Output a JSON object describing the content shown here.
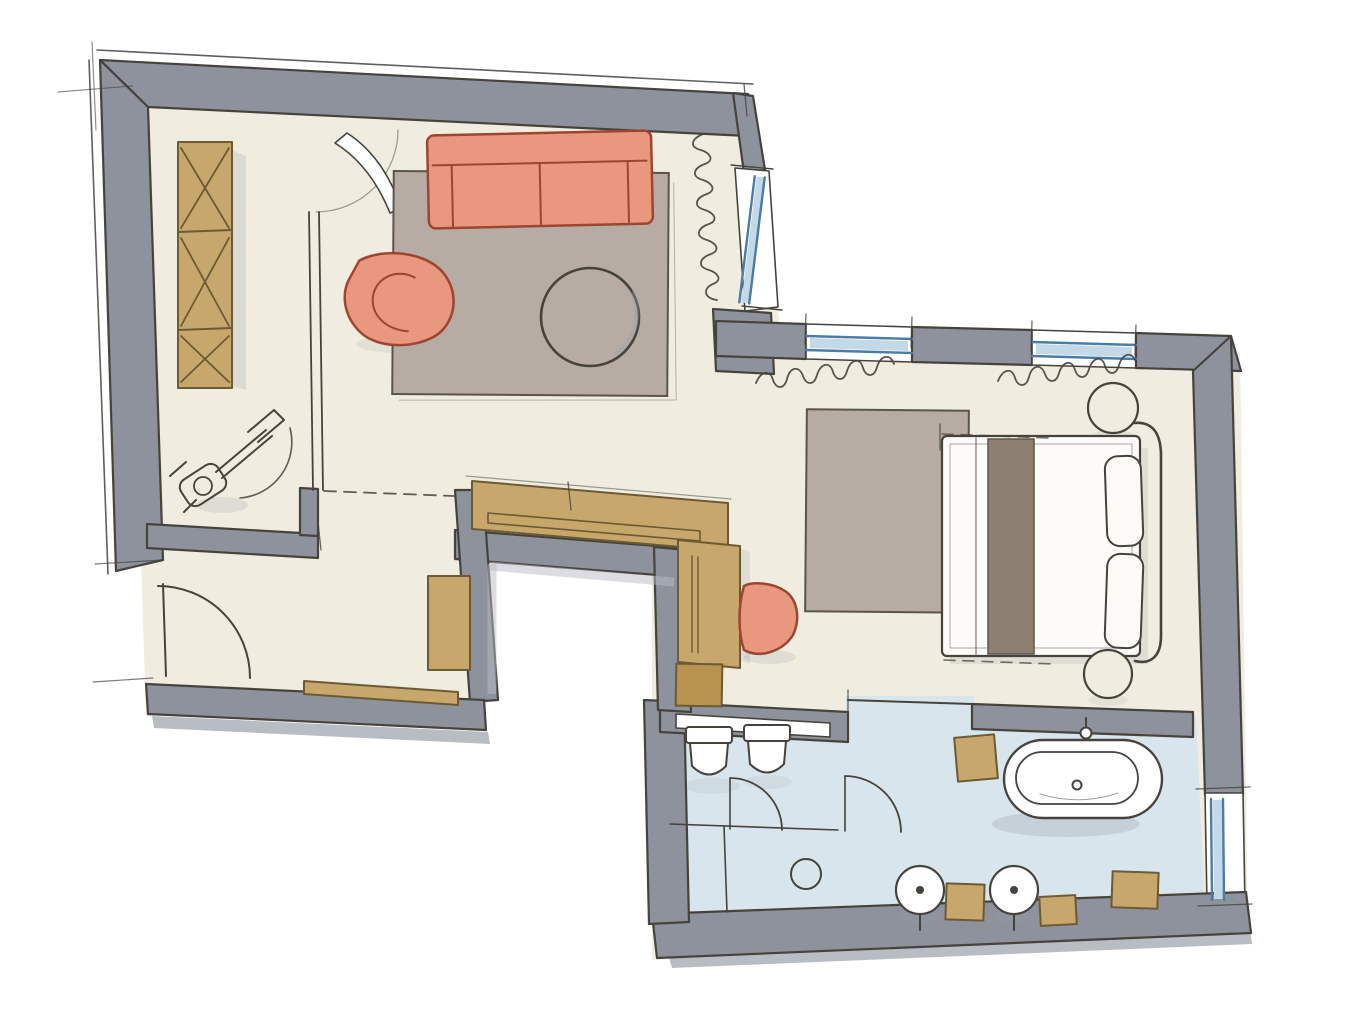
{
  "meta": {
    "kind": "hand-drawn-floor-plan-sketch",
    "canvas": {
      "width": 1366,
      "height": 1024
    }
  },
  "palette": {
    "background": "#ffffff",
    "paper_white": "#ffffff",
    "floor_cream": "#f0ecdf",
    "floor_bath_blue": "#d9e5ec",
    "wall_gray": "#8d929d",
    "wall_shadow": "#b8bcc3",
    "pencil": "#46433d",
    "wood_tan": "#c8a76d",
    "wood_dark": "#6b5a33",
    "wood_dark_sq": "#b8934f",
    "accent_salmon": "#ea977f",
    "salmon_outline": "#9c4630",
    "rug_taupe": "#b7aca4",
    "rug_line": "#5a544d",
    "runner_taupe": "#8d8073",
    "runner_line": "#5f564c",
    "glass_blue_fill": "#c3d9e8",
    "glass_blue_line": "#4a7ca6",
    "shade_gray": "#98a0a8",
    "bed_white": "#fcfbf7"
  },
  "inventory": {
    "rooms": [
      "entry-corridor",
      "living-room",
      "hall",
      "wardrobe-corridor",
      "bedroom",
      "wc",
      "bathroom",
      "light-well-notch"
    ],
    "openings": [
      "entry-door",
      "living-room-door",
      "slanted-living-window",
      "bedroom-window-left",
      "bedroom-window-right",
      "bathroom-window",
      "wc-sliding-slot",
      "wc-door-swing",
      "bathroom-door-swing",
      "open-passage"
    ],
    "furniture": [
      "x-braced-shelf",
      "valet-stand-sketch",
      "sofa",
      "armchair",
      "round-coffee-table",
      "living-rug",
      "hall-bench",
      "hall-cabinet",
      "built-in-counter",
      "tall-closet",
      "wood-cube",
      "dressing-stool",
      "bedroom-rug",
      "double-bed",
      "bed-runner",
      "pillows",
      "round-nightstand",
      "bathtub",
      "wall-hung-toilet",
      "round-washbasin",
      "wooden-stool",
      "floor-drain",
      "curtains"
    ]
  }
}
